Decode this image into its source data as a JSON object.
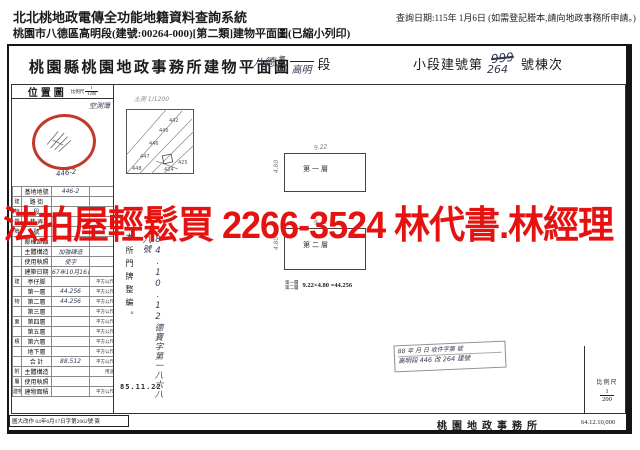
{
  "header": {
    "system_title": "北北桃地政電傳全功能地籍資料查詢系統",
    "query_date": "查詢日期:115年 1月6日 (如需登記謄本,請向地政事務所申請。)",
    "doc_line": "桃園市八德區高明段(建號:00264-000)[第二類]建物平面圖(已縮小列印)"
  },
  "title": {
    "office": "桃園縣桃園地政事務所建物平面圖",
    "district_hw": "八德",
    "township": "鄉",
    "city": "市",
    "section_hw": "高明",
    "section_suffix": "段",
    "bno_prefix": "小段建號第",
    "bno_old_hw": "999",
    "bno_new_hw": "264",
    "bno_suffix": "號棟次"
  },
  "watermark": {
    "text": "法拍屋輕鬆買 2266-3524 林代書.林經理",
    "color": "#e51210"
  },
  "sidebar": {
    "map_title": "位置圖",
    "map_scale_label": "比例尺",
    "map_scale_num": "1",
    "map_scale_den": "1200",
    "map_hw_note": "空測簿",
    "map_hw_parcel": "446-2",
    "rows": [
      {
        "group": "",
        "label": "基地地號",
        "value": "446-2",
        "unit": ""
      },
      {
        "group": "建",
        "label": "路 街",
        "value": "",
        "unit": ""
      },
      {
        "group": "物",
        "label": "段",
        "value": "",
        "unit": ""
      },
      {
        "group": "門",
        "label": "巷 弄",
        "value": "",
        "unit": ""
      },
      {
        "group": "牌",
        "label": "號",
        "value": "",
        "unit": ""
      },
      {
        "group": "",
        "label": "鄰棟距離",
        "value": "",
        "unit": ""
      },
      {
        "group": "",
        "label": "主體構造",
        "value": "加強磚造",
        "unit": ""
      },
      {
        "group": "",
        "label": "使用執照",
        "value": "使字",
        "unit": ""
      },
      {
        "group": "",
        "label": "建築日期",
        "value": "67年10月16日",
        "unit": ""
      },
      {
        "group": "建",
        "label": "亭仔脚",
        "value": "",
        "unit": "平方公尺"
      },
      {
        "group": "",
        "label": "第一層",
        "value": "44.256",
        "unit": "平方公尺"
      },
      {
        "group": "物",
        "label": "第二層",
        "value": "44.256",
        "unit": "平方公尺"
      },
      {
        "group": "",
        "label": "第三層",
        "value": "",
        "unit": "平方公尺"
      },
      {
        "group": "面",
        "label": "第四層",
        "value": "",
        "unit": "平方公尺"
      },
      {
        "group": "",
        "label": "第五層",
        "value": "",
        "unit": "平方公尺"
      },
      {
        "group": "積",
        "label": "第六層",
        "value": "",
        "unit": "平方公尺"
      },
      {
        "group": "",
        "label": "地下層",
        "value": "",
        "unit": "平方公尺"
      },
      {
        "group": "",
        "label": "合 計",
        "value": "88.512",
        "unit": "平方公尺"
      },
      {
        "group": "附",
        "label": "主體構造",
        "value": "",
        "unit": "用途"
      },
      {
        "group": "屬",
        "label": "使用執照",
        "value": "",
        "unit": ""
      },
      {
        "group": "建物",
        "label": "建物面積",
        "value": "",
        "unit": "平方公尺"
      }
    ]
  },
  "sketch": {
    "hw_note": "土測 1/1200",
    "parcels": [
      "442",
      "445",
      "446",
      "447",
      "448",
      "425",
      "424"
    ]
  },
  "renumber_stamp": {
    "printed": "本所門牌整編。",
    "hw": "84.10.12德寶字第一八六八八號"
  },
  "dates": {
    "stamp_date": "85.11.22"
  },
  "floorplan": {
    "floor1_label": "第一層",
    "floor2_label": "第二層",
    "dim_width": "9.22",
    "dim_height": "4.80",
    "note_line1": "第一層",
    "note_line2": "第二層",
    "note_formula": "9.22×4.80 =44.256"
  },
  "reg_stamp": {
    "line1": "88 年 月 日 收件字第 號",
    "line2": "高明段 446 改 264 建號"
  },
  "scale_box": {
    "label": "比例尺",
    "num": "1",
    "den": "200"
  },
  "footer": {
    "left_stamp": "圖大改作 64年6月17日字第2662號 簽",
    "office": "桃園地政事務所",
    "print_code": "64.12.10,000"
  }
}
